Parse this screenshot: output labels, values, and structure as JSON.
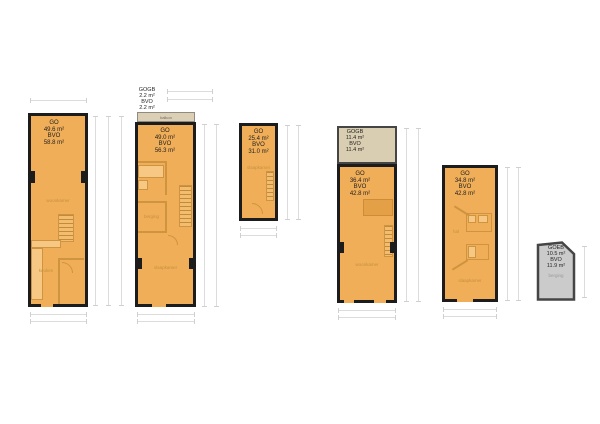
{
  "title": "Floor plans overview",
  "colors": {
    "floor_fill": "#f0ae58",
    "wall": "#1c1c1c",
    "interior_wall": "#cf9440",
    "fixture_fill": "#f6c884",
    "balcony_fill": "#dbcfb6",
    "terrace_fill": "#d9cdb2",
    "shed_fill": "#cbcbcb",
    "shed_wall": "#454545",
    "dimension_line": "#dcdcdc"
  },
  "plans": [
    {
      "area_label": "GO\n49.6 m²\nBVO\n58.8 m²",
      "room_living": "woonkamer",
      "room_kitchen": "keuken"
    },
    {
      "annex_label": "GOGB\n2.2 m²\nBVO\n2.2 m²",
      "balcony_label": "balkon",
      "area_label": "GO\n49.0 m²\nBVO\n56.3 m²",
      "room_storage": "berging",
      "room_bedroom": "slaapkamer"
    },
    {
      "area_label": "GO\n25.4 m²\nBVO\n31.0 m²",
      "room_bedroom": "slaapkamer"
    },
    {
      "annex_label": "GOGB\n11.4 m²\nBVO\n11.4 m²",
      "area_label": "GO\n36.4 m²\nBVO\n42.8 m²",
      "room_living": "woonkamer"
    },
    {
      "area_label": "GO\n34.8 m²\nBVO\n42.8 m²",
      "room_hall": "hal",
      "room_bedroom": "slaapkamer"
    },
    {
      "area_label": "GOEB\n10.5 m²\nBVO\n11.9 m²",
      "room_storage": "berging"
    }
  ]
}
